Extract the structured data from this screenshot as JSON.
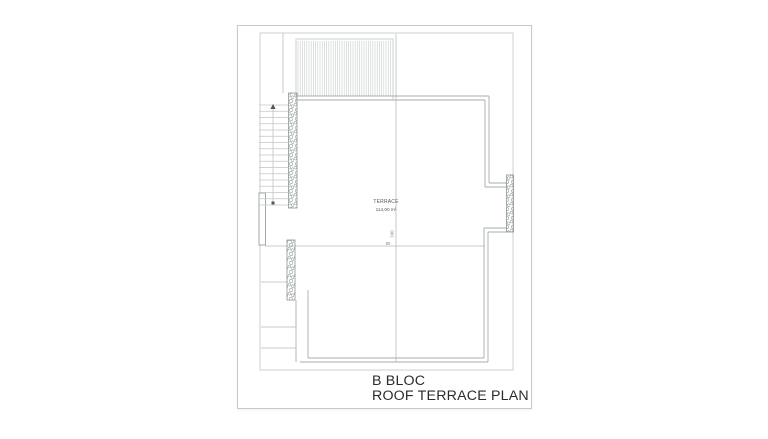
{
  "title_block": {
    "line1": "B BLOC",
    "line2": "ROOF TERRACE PLAN"
  },
  "room": {
    "name": "TERRACE",
    "area": "114,00 m²"
  },
  "dimensions": {
    "vertical_label": "100",
    "horizontal_label": "90"
  },
  "colors": {
    "paper": "#ffffff",
    "frame_line": "#ccd0d0",
    "light_line": "#b8bebe",
    "parapet_line": "#a6acac",
    "hatch_stroke": "#8f9595",
    "title_text": "#2b2b2b"
  },
  "plan": {
    "frame": {
      "x": 260,
      "y": 33,
      "w": 253,
      "h": 337
    },
    "pergola": {
      "x": 296,
      "y": 39,
      "w": 97,
      "h": 61,
      "step": 2.2
    },
    "lines": [
      [
        283,
        33,
        283,
        93,
        "l"
      ],
      [
        396,
        34,
        396,
        362,
        "l"
      ],
      [
        297,
        96,
        489,
        96,
        "m"
      ],
      [
        297,
        100,
        485,
        100,
        "m"
      ],
      [
        489,
        96,
        489,
        183,
        "m"
      ],
      [
        485,
        100,
        485,
        187,
        "m"
      ],
      [
        489,
        183,
        507,
        183,
        "m"
      ],
      [
        485,
        187,
        507,
        187,
        "m"
      ],
      [
        507,
        228,
        484,
        228,
        "m"
      ],
      [
        507,
        232,
        488,
        232,
        "m"
      ],
      [
        484,
        228,
        484,
        358,
        "m"
      ],
      [
        488,
        232,
        488,
        362,
        "m"
      ],
      [
        308,
        358,
        484,
        358,
        "m"
      ],
      [
        300,
        362,
        488,
        362,
        "m"
      ],
      [
        308,
        290,
        308,
        358,
        "m"
      ],
      [
        296,
        300,
        296,
        362,
        "m"
      ],
      [
        265,
        246,
        485,
        246,
        "l"
      ],
      [
        261,
        282,
        288,
        282,
        "l"
      ],
      [
        261,
        327,
        296,
        327,
        "l"
      ],
      [
        261,
        348,
        296,
        348,
        "l"
      ],
      [
        296,
        327,
        296,
        348,
        "l"
      ]
    ],
    "hatch_walls": [
      {
        "x": 288.5,
        "y": 93,
        "w": 8.5,
        "h": 115
      },
      {
        "x": 287,
        "y": 240,
        "w": 8,
        "h": 60
      },
      {
        "x": 506.5,
        "y": 175,
        "w": 7,
        "h": 57
      }
    ],
    "wall_segment": {
      "x": 259,
      "y": 193,
      "w": 6.5,
      "h": 52
    },
    "stairs": {
      "x1": 259,
      "x2": 288,
      "y1": 105,
      "y2": 205,
      "count": 17,
      "arrow_x": 273
    }
  }
}
